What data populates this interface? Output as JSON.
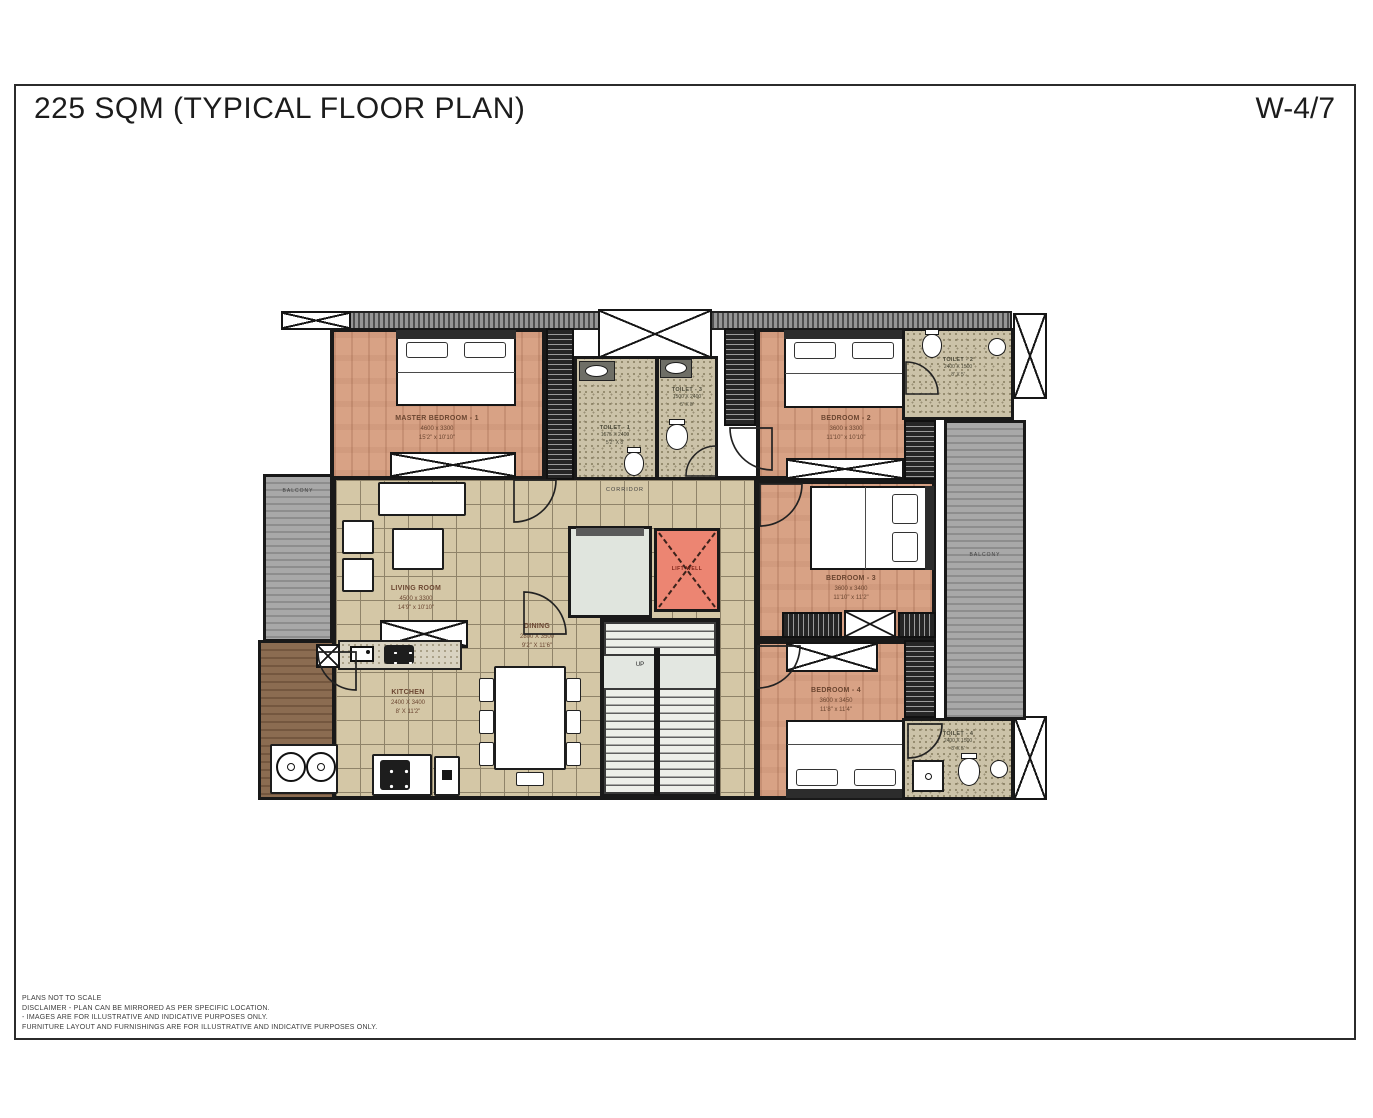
{
  "title": "225 SQM (TYPICAL FLOOR PLAN)",
  "sheet_no": "W-4/7",
  "rooms": {
    "master_bedroom": {
      "name": "MASTER BEDROOM - 1",
      "mm": "4600 x 3300",
      "ft": "15'2\" x 10'10\""
    },
    "bedroom2": {
      "name": "BEDROOM - 2",
      "mm": "3600 x 3300",
      "ft": "11'10\" x 10'10\""
    },
    "bedroom3": {
      "name": "BEDROOM - 3",
      "mm": "3600 x 3400",
      "ft": "11'10\" x 11'2\""
    },
    "bedroom4": {
      "name": "BEDROOM - 4",
      "mm": "3600 x 3450",
      "ft": "11'8\" x 11'4\""
    },
    "toilet1": {
      "name": "TOILET - 1",
      "mm": "1575 X 2400",
      "ft": "5'2\" X 8'"
    },
    "toilet2": {
      "name": "TOILET - 2",
      "mm": "2400 X 1500",
      "ft": "8' X 5'"
    },
    "toilet3": {
      "name": "TOILET - 3",
      "mm": "1500 X 2400",
      "ft": "5' X 8'"
    },
    "toilet4": {
      "name": "TOILET - 4",
      "mm": "2400 X 1500",
      "ft": "8' X 5'"
    },
    "living": {
      "name": "LIVING ROOM",
      "mm": "4500 x 3300",
      "ft": "14'9\" x 10'10\""
    },
    "dining": {
      "name": "DINING",
      "mm": "2800 X 3500",
      "ft": "9'2\" X 11'6\""
    },
    "kitchen": {
      "name": "KITCHEN",
      "mm": "2400 X 3400",
      "ft": "8' X 11'2\""
    }
  },
  "labels": {
    "corridor": "CORRIDOR",
    "lift": "LIFT WELL",
    "up": "UP",
    "balcony_left": "BALCONY",
    "balcony_right": "BALCONY"
  },
  "footer": {
    "line1": "PLANS NOT TO SCALE",
    "line2": "DISCLAIMER - PLAN CAN BE MIRRORED AS PER SPECIFIC LOCATION.",
    "line3": "- IMAGES ARE  FOR ILLUSTRATIVE AND INDICATIVE PURPOSES ONLY.",
    "line4": "FURNITURE LAYOUT AND FURNISHINGS ARE FOR ILLUSTRATIVE AND INDICATIVE PURPOSES ONLY."
  },
  "colors": {
    "lift_well": "#ec8572",
    "bedroom_floor": "#d8a285",
    "tile_floor": "#d4c7a6",
    "wall": "#191919"
  }
}
